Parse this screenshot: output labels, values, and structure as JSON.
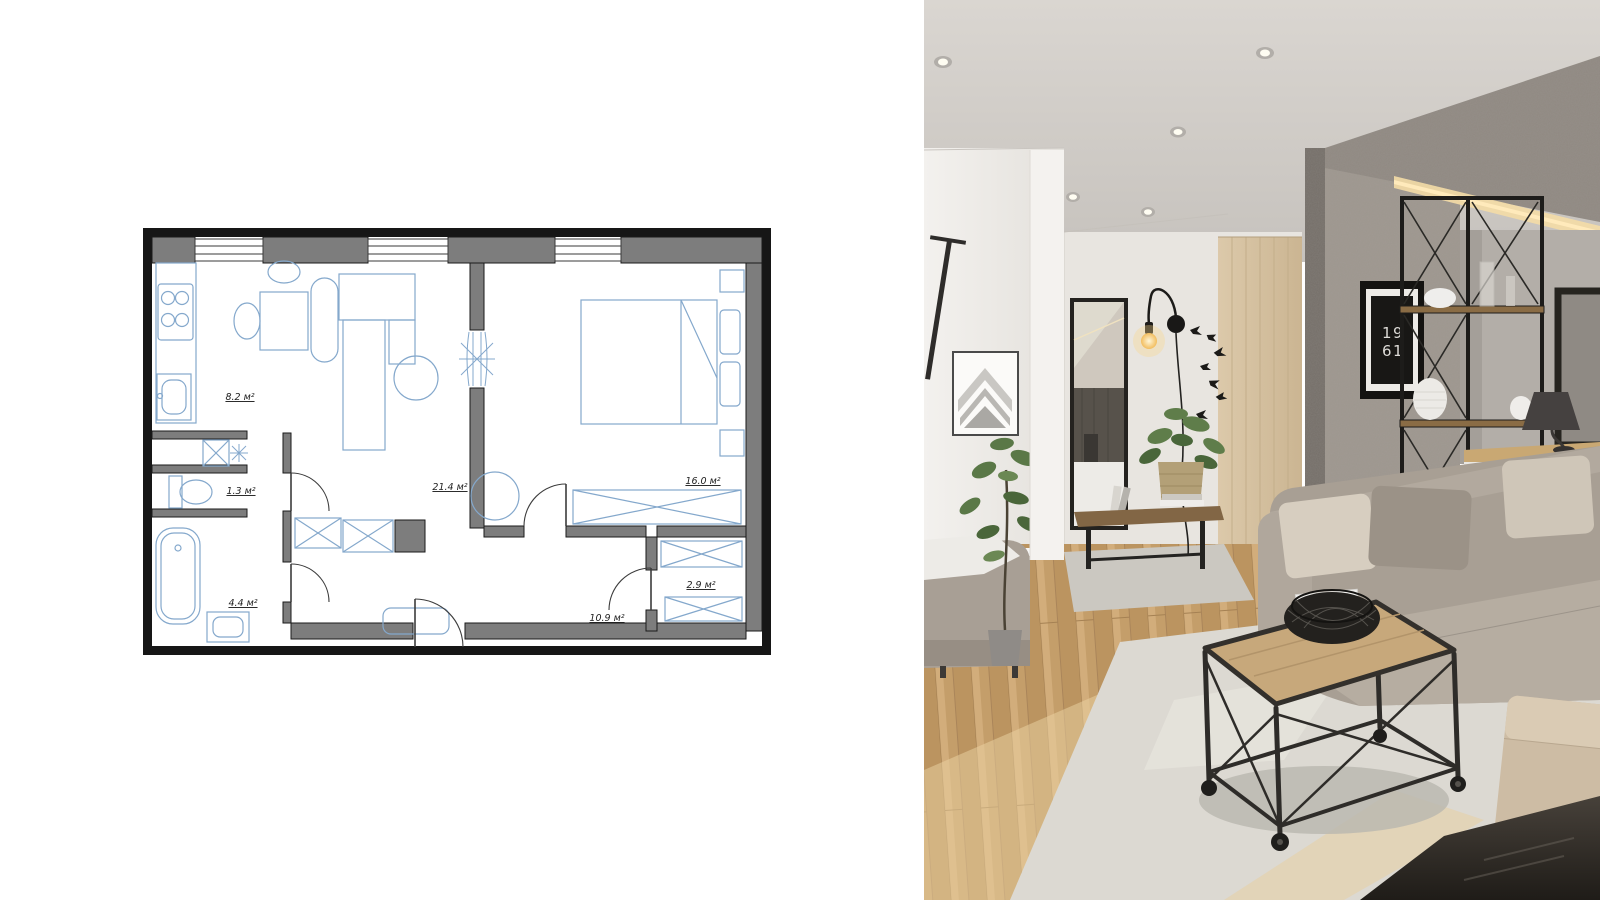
{
  "floor_plan": {
    "rooms": {
      "kitchen": "8.2 м²",
      "wc": "1.3 м²",
      "bathroom": "4.4 м²",
      "living_room": "21.4 м²",
      "bedroom": "16.0 м²",
      "closet": "2.9 м²",
      "hallway": "10.9 м²"
    },
    "colors": {
      "wall_fill": "#7d7d7d",
      "outline": "#1a1a1a",
      "furniture": "#84a8cc"
    }
  },
  "photo": {
    "poster": {
      "line1": "19",
      "line2": "61"
    },
    "colors": {
      "ceiling": "#d3cfca",
      "wall": "#f0eeeb",
      "concrete": "#9d968e",
      "wood_floor": "#c9a46f",
      "rug": "#dcd9d2",
      "sofa": "#a89f94",
      "lamp_glow": "#f7c96b",
      "led_strip": "#f4dca6"
    }
  }
}
